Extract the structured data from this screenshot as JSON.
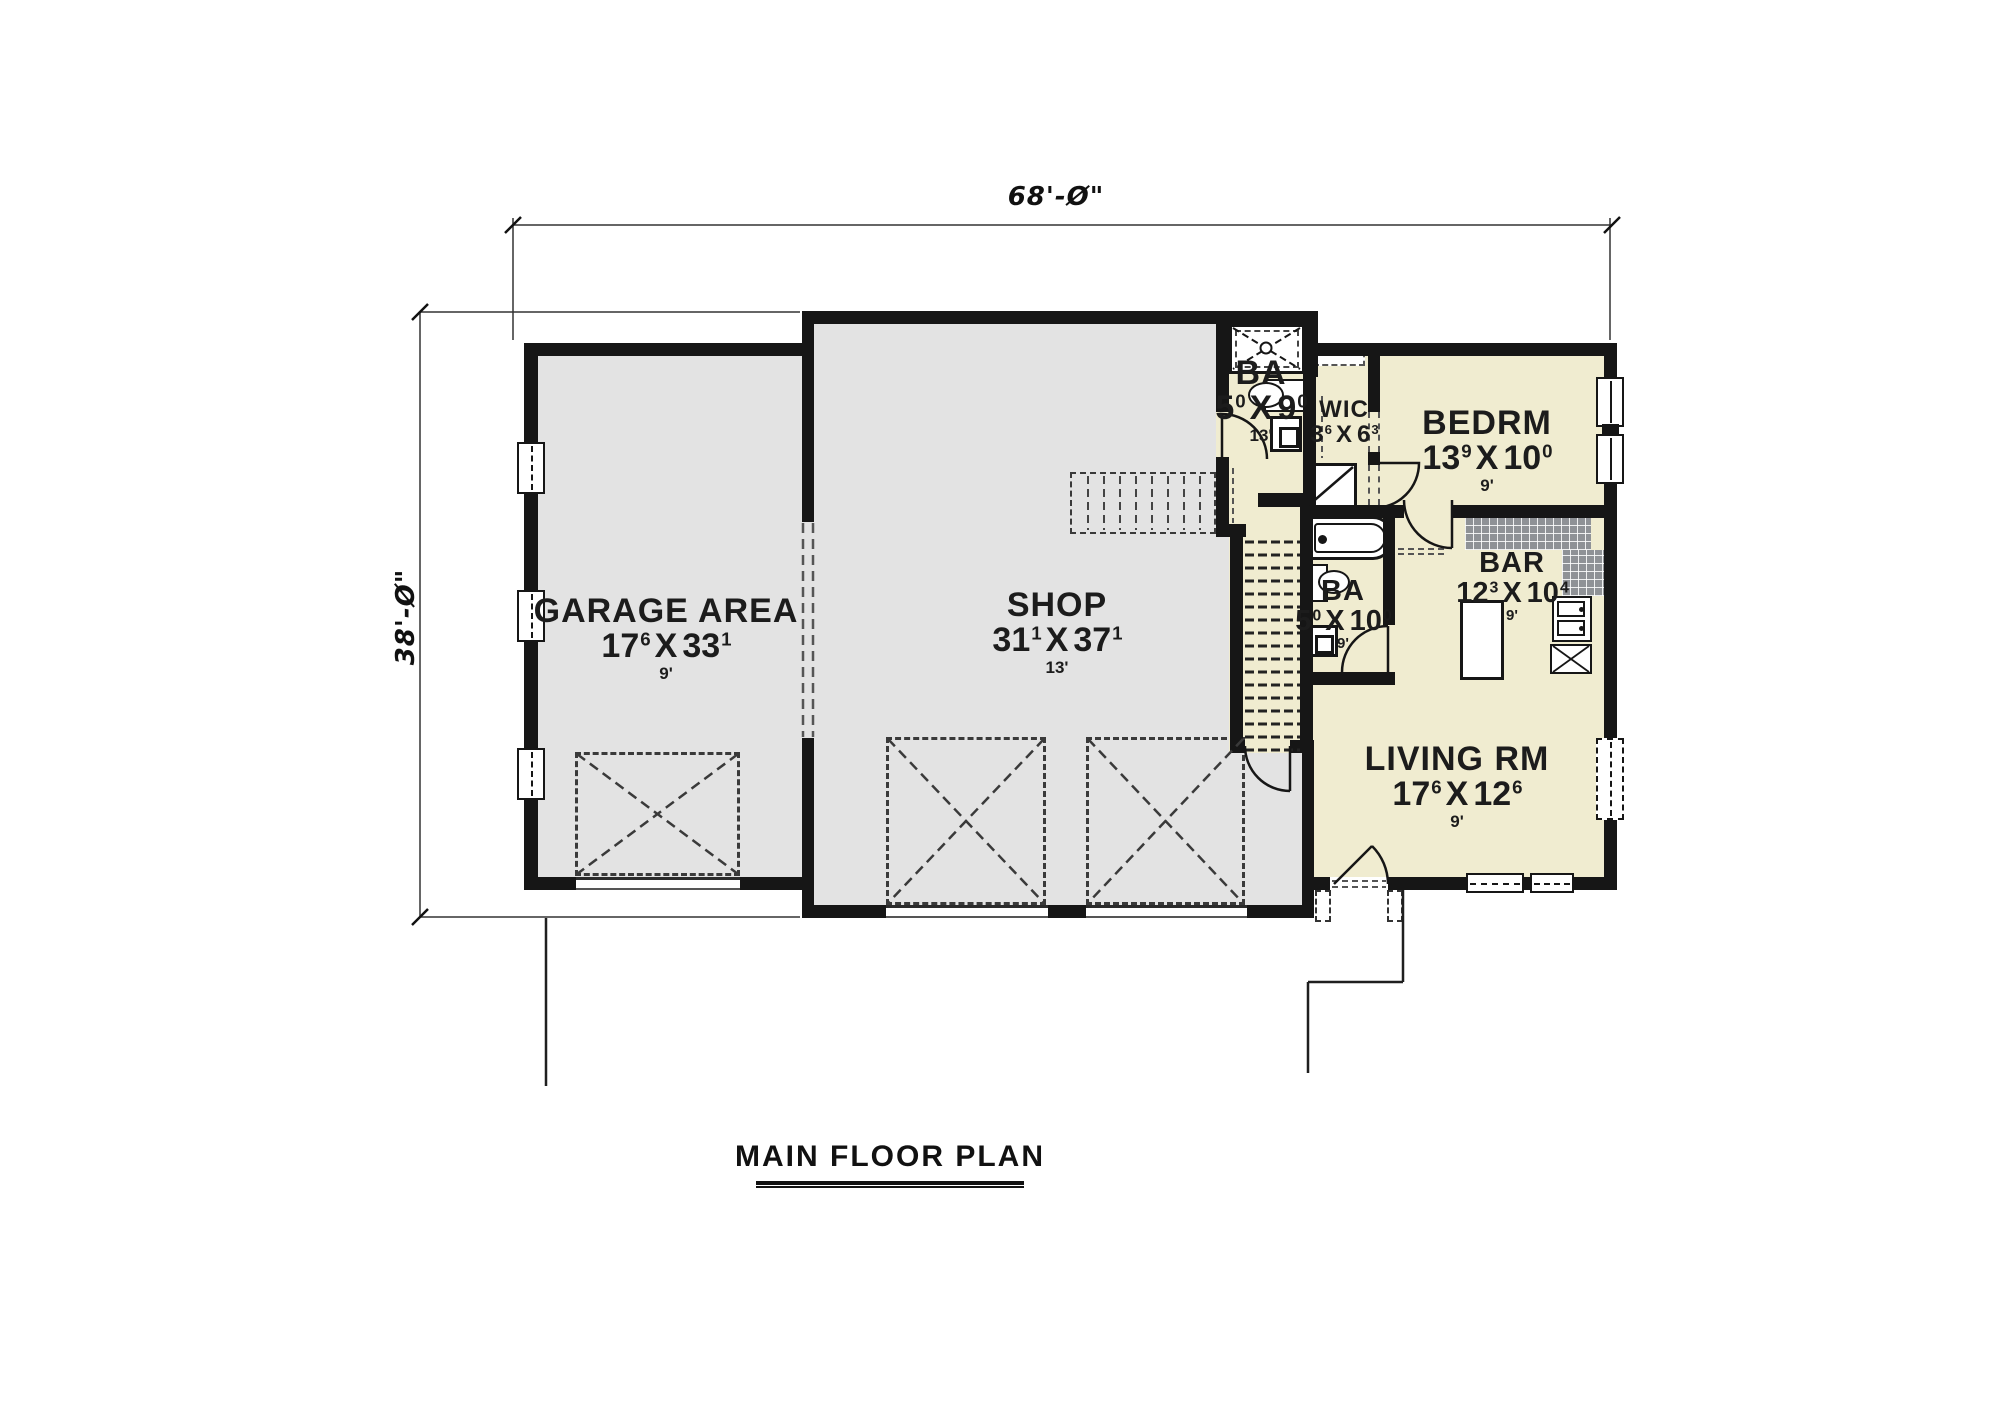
{
  "title": "MAIN FLOOR PLAN",
  "dimensions": {
    "overall_width": "68'-Ø\"",
    "overall_height": "38'-Ø\""
  },
  "dim_separator": "X",
  "rooms": {
    "garage": {
      "label": "GARAGE AREA",
      "w": "17",
      "w_in": "6",
      "l": "33",
      "l_in": "1",
      "ceiling": "9'"
    },
    "shop": {
      "label": "SHOP",
      "w": "31",
      "w_in": "1",
      "l": "37",
      "l_in": "1",
      "ceiling": "13'"
    },
    "bath1": {
      "label": "BA",
      "w": "5",
      "w_in": "0",
      "l": "9",
      "l_in": "0",
      "ceiling": "13'"
    },
    "wic": {
      "label": "WIC",
      "w": "3",
      "w_in": "6",
      "l": "6",
      "l_in": "3",
      "ceiling": ""
    },
    "bedroom": {
      "label": "BEDRM",
      "w": "13",
      "w_in": "9",
      "l": "10",
      "l_in": "0",
      "ceiling": "9'"
    },
    "bar": {
      "label": "BAR",
      "w": "12",
      "w_in": "3",
      "l": "10",
      "l_in": "4",
      "ceiling": "9'"
    },
    "bath2": {
      "label": "BA",
      "w": "5",
      "w_in": "0",
      "l": "10",
      "l_in": "0",
      "ceiling": "9'"
    },
    "living": {
      "label": "LIVING RM",
      "w": "17",
      "w_in": "6",
      "l": "12",
      "l_in": "6",
      "ceiling": "9'"
    }
  },
  "colors": {
    "wall": "#161616",
    "room_gray": "#e3e3e3",
    "room_cream": "#f0ecd0",
    "counter": "#8f9296",
    "line": "#2b2b2b"
  },
  "fixtures": [
    "shower",
    "toilet",
    "sink-vanity",
    "bathtub",
    "kitchen-sink",
    "range",
    "kitchen-island",
    "closet",
    "closet-shelf",
    "stairs",
    "upper-stairs-dashed",
    "garage-door",
    "entry-door",
    "window",
    "porch-post",
    "wall-opening"
  ]
}
